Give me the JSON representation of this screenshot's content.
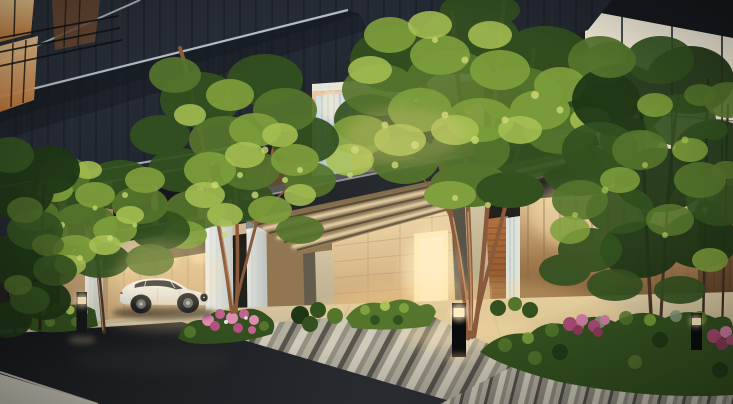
{
  "scene": {
    "title": "Residential entrance perspective at dusk",
    "setting": "Photoreal architectural rendering: luxury condominium porte-cochère at dusk with illuminated canopy, white sedan in carport, landscaped garden and striped stone paving",
    "time_of_day": "dusk",
    "objects": {
      "building": "dark panelled tower facade with lit corner windows",
      "canopy": "bronze entrance canopy with linear LED downlights",
      "carport": "drive-through carport with fluted white pilasters",
      "car": "white luxury sedan",
      "entrance": "warmly lit entrance doorway with wood slat wall",
      "garden": "evergreen shrubs with pink and magenta azalea blooms",
      "paving": "striped granite crossings, beige stone court, asphalt street",
      "lighting": "bollard lights, recessed downlights, wall washers"
    }
  },
  "palette": {
    "baseBg": "#23211c",
    "facadeHi": "#2b313b",
    "facadeLo": "#1a1f27",
    "facadeSeam": "#10151b",
    "facadeSeamLight": "#3b444e",
    "slabLight": "#c4cdd4",
    "glass1": "#f0ead9",
    "glass2": "#f6ecd6",
    "glass3": "#d2ccba",
    "glass4": "#8b8b7f",
    "glass5": "#4f5048",
    "mullion": "#2e3338",
    "glassWarm": "#f8ecd4",
    "roofDark": "#15181d",
    "winHi": "#f5cd92",
    "winLo": "#bd7438",
    "winDim": "#6e4a30",
    "railDark": "#0e1114",
    "peachHi": "#f2cfa8",
    "peachLo": "#bf8a62",
    "peachShade": "#9a6848",
    "louverHi": "#d6dee2",
    "louverLo": "#b4c2ca",
    "louverLine": "#a9bac4",
    "wallCHi": "#eed6a4",
    "wallCLo": "#c7a575",
    "wallJoint": "#b3906a",
    "wallEHi": "#f6e2b6",
    "wallELo": "#c8a372",
    "doorGlow": "#ffe7b4",
    "doorCore": "#fff7de",
    "woodHi": "#b5723f",
    "woodLo": "#7e4a26",
    "woodLine": "#5e3518",
    "fence1": "#eed2a2",
    "fence2": "#a37c50",
    "fence3": "#5e4124",
    "fencePost": "#8a6440",
    "fenceDark": "#4e3722",
    "pilasterHi": "#eff1ec",
    "pilasterLo": "#c3c9c5",
    "pilasterLine": "#cfd3cd",
    "colLightHi": "#d0c3a2",
    "colLightLo": "#ab9e7e",
    "colDark": "#635c4c",
    "canopyFascia1": "#1f2225",
    "canopyFascia2": "#30353a",
    "canopyEdge": "#a8aeb0",
    "canopyTop": "#555c60",
    "soffitHi": "#98825d",
    "soffitLo": "#6b573c",
    "slatDark": "#3d3425",
    "led": "#ffe9bd",
    "courtHi": "#dbcba3",
    "courtLo": "#aa9c7f",
    "courtWarm": "#ffd98e",
    "stripeL": "#cfcabb",
    "stripeM": "#918d80",
    "stripeM2": "#b3aea0",
    "stripeD": "#52504a",
    "asphaltHi": "#2e3136",
    "asphaltLo": "#131518",
    "curb": "#d6cfb8",
    "sidewalk": "#d9d5c6",
    "leaf1": "#1f3616",
    "leaf2": "#33511f",
    "leaf3": "#55752c",
    "leaf4": "#7fa03c",
    "leaf5": "#a8c253",
    "leaf6": "#ccd976",
    "leafGray": "#8a9a7c",
    "trunkMain": "#8a5a3c",
    "trunkLight": "#c89a6e",
    "trunkDark": "#4a3526",
    "pink1": "#e08cb0",
    "pink2": "#c2638f",
    "magenta1": "#a84a72",
    "magenta2": "#cf7ba2",
    "bollardHi": "#222526",
    "bollardLo": "#0a0b0c",
    "bollardLight": "#fff1c6",
    "carBodyHi": "#fafaf7",
    "carBodyLo": "#d6d6cf",
    "carGlass": "#2a3038",
    "carDetail": "#9aa0a4",
    "bloomWarm": "#ffecc0",
    "glowWarm": "#ffdfa6",
    "vignette": "rgba(8,10,9,0.42)"
  }
}
